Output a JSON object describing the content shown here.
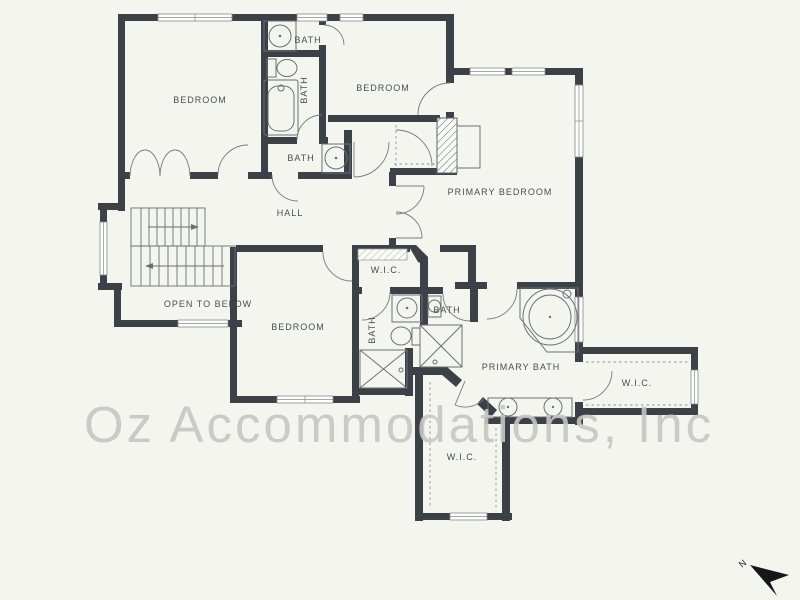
{
  "plan": {
    "rooms": {
      "bedroom1": "BEDROOM",
      "bedroom2": "BEDROOM",
      "bedroom3": "BEDROOM",
      "primary_bedroom": "PRIMARY BEDROOM",
      "hall": "HALL",
      "open_to_below": "OPEN TO BELOW",
      "bath1": "BATH",
      "bath2": "BATH",
      "bath3": "BATH",
      "bath4": "BATH",
      "bath5": "BATH",
      "primary_bath": "PRIMARY BATH",
      "wic1": "W.I.C.",
      "wic2": "W.I.C.",
      "wic3": "W.I.C."
    },
    "compass": {
      "north_label": "N"
    },
    "watermark": "Oz Accommodations, Inc",
    "colors": {
      "background": "#f5f5f0",
      "wall": "#3b4146",
      "fixture_line": "#6a7075",
      "label_text": "#474e54",
      "watermark_text": "#c6c7c3",
      "north_arrow": "#15181b"
    }
  }
}
